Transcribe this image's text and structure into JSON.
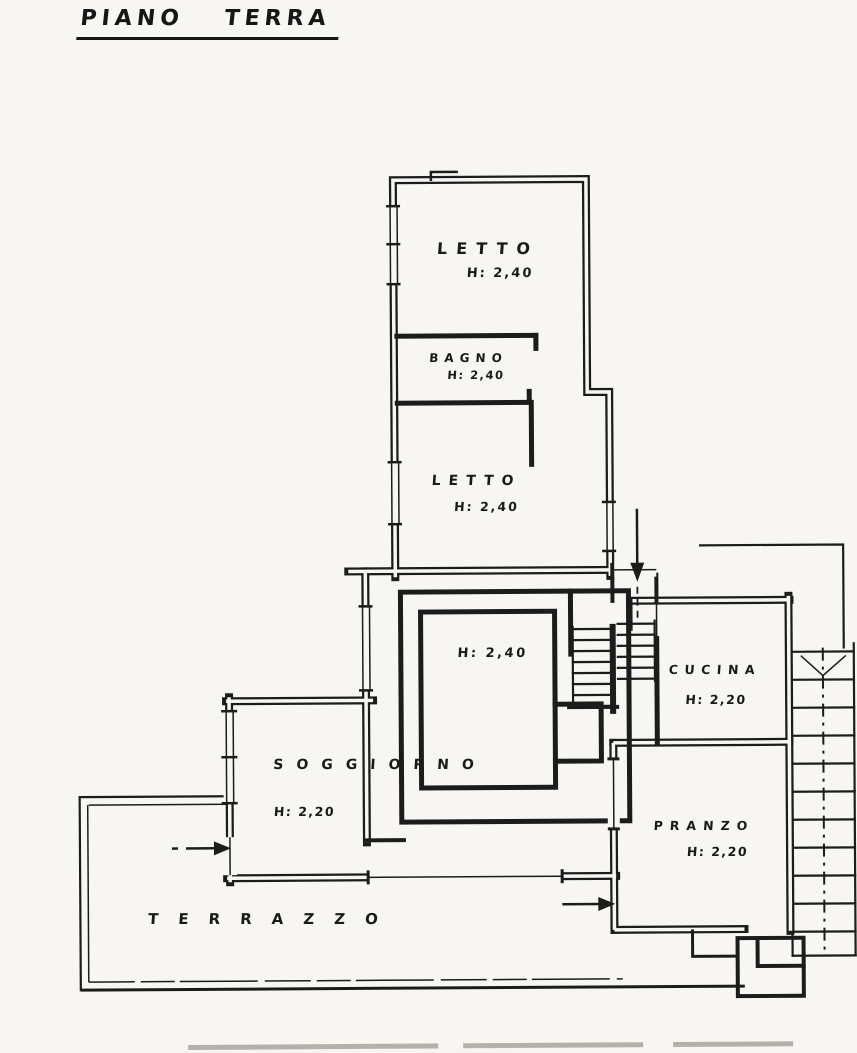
{
  "page": {
    "title": "PIANO TERRA"
  },
  "rooms": {
    "letto1": {
      "name": "LETTO",
      "height": "H: 2,40"
    },
    "bagno": {
      "name": "BAGNO",
      "height": "H: 2,40"
    },
    "letto2": {
      "name": "LETTO",
      "height": "H: 2,40"
    },
    "disimpegno": {
      "name": "",
      "height": "H: 2,40"
    },
    "soggiorno": {
      "name": "SOGGIORNO",
      "height": "H: 2,20"
    },
    "cucina": {
      "name": "CUCINA",
      "height": "H: 2,20"
    },
    "pranzo": {
      "name": "PRANZO",
      "height": "H: 2,20"
    },
    "terrazzo": {
      "name": "TERRAZZO"
    }
  },
  "colors": {
    "ink": "#1c1c1c",
    "paper": "#f7f6f2"
  }
}
